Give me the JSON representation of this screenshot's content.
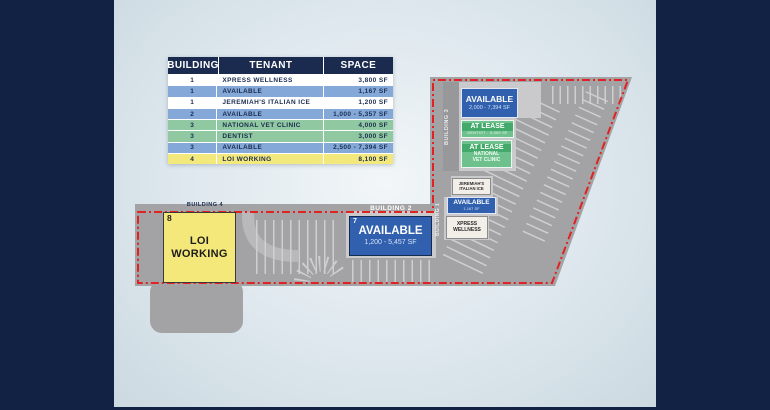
{
  "table": {
    "headers": [
      "BUILDING",
      "TENANT",
      "SPACE"
    ],
    "rows": [
      {
        "building": "1",
        "tenant": "XPRESS WELLNESS",
        "space": "3,800 SF",
        "status": "white"
      },
      {
        "building": "1",
        "tenant": "AVAILABLE",
        "space": "1,167 SF",
        "status": "blue"
      },
      {
        "building": "1",
        "tenant": "JEREMIAH'S ITALIAN ICE",
        "space": "1,200 SF",
        "status": "white"
      },
      {
        "building": "2",
        "tenant": "AVAILABLE",
        "space": "1,000 - 5,357 SF",
        "status": "blue"
      },
      {
        "building": "3",
        "tenant": "NATIONAL VET CLINIC",
        "space": "4,000 SF",
        "status": "green"
      },
      {
        "building": "3",
        "tenant": "DENTIST",
        "space": "3,000 SF",
        "status": "green"
      },
      {
        "building": "3",
        "tenant": "AVAILABLE",
        "space": "2,500 - 7,394 SF",
        "status": "blue"
      },
      {
        "building": "4",
        "tenant": "LOI WORKING",
        "space": "8,100 SF",
        "status": "yellow"
      }
    ]
  },
  "map": {
    "building3": {
      "label": "BUILDING 3",
      "available": {
        "title": "AVAILABLE",
        "space": "2,000 - 7,394 SF"
      },
      "at_lease_dentist": {
        "title": "AT LEASE",
        "detail": "DENTIST - 3,000 SF"
      },
      "at_lease_vet": {
        "title": "AT LEASE",
        "detail_line1": "NATIONAL",
        "detail_line2": "VET CLINIC"
      }
    },
    "building1": {
      "label": "BUILDING 1",
      "jeremiahs": {
        "line1": "JEREMIAH'S",
        "line2": "ITALIAN ICE"
      },
      "available": {
        "title": "AVAILABLE",
        "space": "1,167 SF"
      },
      "xpress": {
        "line1": "XPRESS",
        "line2": "WELLNESS"
      }
    },
    "building2": {
      "label": "BUILDING 2",
      "unit_number": "7",
      "available": {
        "title": "AVAILABLE",
        "space": "1,200 - 5,457 SF"
      }
    },
    "building4": {
      "label": "BUILDING 4",
      "unit_number": "8",
      "tenant": "LOI WORKING"
    }
  },
  "colors": {
    "frame_navy": "#122244",
    "table_header_navy": "#1b2b50",
    "available_blue": "#3060ae",
    "available_row_blue": "#84a9d8",
    "lease_green": "#6ec08c",
    "lease_row_green": "#90c9a1",
    "loi_yellow": "#f5e87b",
    "boundary_red": "#e02222",
    "lot_gray": "#a3a3a5"
  }
}
